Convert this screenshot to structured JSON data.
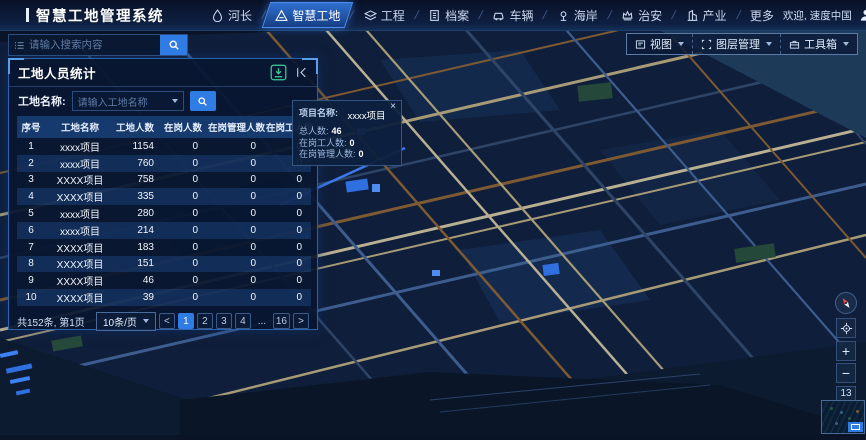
{
  "header": {
    "title": "智慧工地管理系统",
    "welcome": "欢迎, 速度中国",
    "nav": [
      {
        "id": "river-chief",
        "label": "河长",
        "icon": "droplet"
      },
      {
        "id": "smart-site",
        "label": "智慧工地",
        "icon": "site",
        "active": true
      },
      {
        "id": "engineering",
        "label": "工程",
        "icon": "layers"
      },
      {
        "id": "archives",
        "label": "档案",
        "icon": "file"
      },
      {
        "id": "vehicles",
        "label": "车辆",
        "icon": "car"
      },
      {
        "id": "coast",
        "label": "海岸",
        "icon": "pin"
      },
      {
        "id": "security",
        "label": "治安",
        "icon": "crown"
      },
      {
        "id": "industry",
        "label": "产业",
        "icon": "building"
      },
      {
        "id": "more",
        "label": "更多",
        "icon": ""
      }
    ]
  },
  "search": {
    "placeholder": "请输入搜索内容"
  },
  "map_toolbar": [
    {
      "id": "view",
      "label": "视图",
      "icon": "doc"
    },
    {
      "id": "layer-manager",
      "label": "图层管理",
      "icon": "square"
    },
    {
      "id": "toolbox",
      "label": "工具箱",
      "icon": "toolbox"
    }
  ],
  "panel": {
    "title": "工地人员统计",
    "filter": {
      "label": "工地名称:",
      "placeholder": "请输入工地名称"
    },
    "table": {
      "columns": [
        "序号",
        "工地名称",
        "工地人数",
        "在岗人数",
        "在岗管理人数",
        "在岗工人数"
      ],
      "rows": [
        [
          "1",
          "xxxx项目",
          "1154",
          "0",
          "0",
          "0"
        ],
        [
          "2",
          "xxxx项目",
          "760",
          "0",
          "0",
          "0"
        ],
        [
          "3",
          "XXXX项目",
          "758",
          "0",
          "0",
          "0"
        ],
        [
          "4",
          "XXXX项目",
          "335",
          "0",
          "0",
          "0"
        ],
        [
          "5",
          "xxxx项目",
          "280",
          "0",
          "0",
          "0"
        ],
        [
          "6",
          "xxxx项目",
          "214",
          "0",
          "0",
          "0"
        ],
        [
          "7",
          "XXXX项目",
          "183",
          "0",
          "0",
          "0"
        ],
        [
          "8",
          "XXXX项目",
          "151",
          "0",
          "0",
          "0"
        ],
        [
          "9",
          "XXXX项目",
          "46",
          "0",
          "0",
          "0"
        ],
        [
          "10",
          "XXXX项目",
          "39",
          "0",
          "0",
          "0"
        ]
      ]
    },
    "footer": {
      "total_text": "共152条, 第1页",
      "page_size": "10条/页",
      "prev": "<",
      "next": ">",
      "pages": [
        "1",
        "2",
        "3",
        "4",
        "...",
        "16"
      ],
      "active_page": "1"
    }
  },
  "popup": {
    "name_label": "项目名称:",
    "name_value": "xxxx项目",
    "close": "×",
    "stats": [
      {
        "label": "总人数:",
        "value": "46"
      },
      {
        "label": "在岗工人数:",
        "value": "0"
      },
      {
        "label": "在岗管理人数:",
        "value": "0"
      }
    ]
  },
  "map_controls": {
    "zoom_in": "+",
    "zoom_out": "−",
    "zoom_level": "13"
  },
  "colors": {
    "accent": "#2e7ce4",
    "panel_border": "#2b62a8",
    "download_green": "#3ecf9a",
    "road_tan": "#a79b77",
    "road_brown": "#7d5a33",
    "road_blue": "#3d5d8f",
    "building_blue": "#2f6fe0"
  }
}
